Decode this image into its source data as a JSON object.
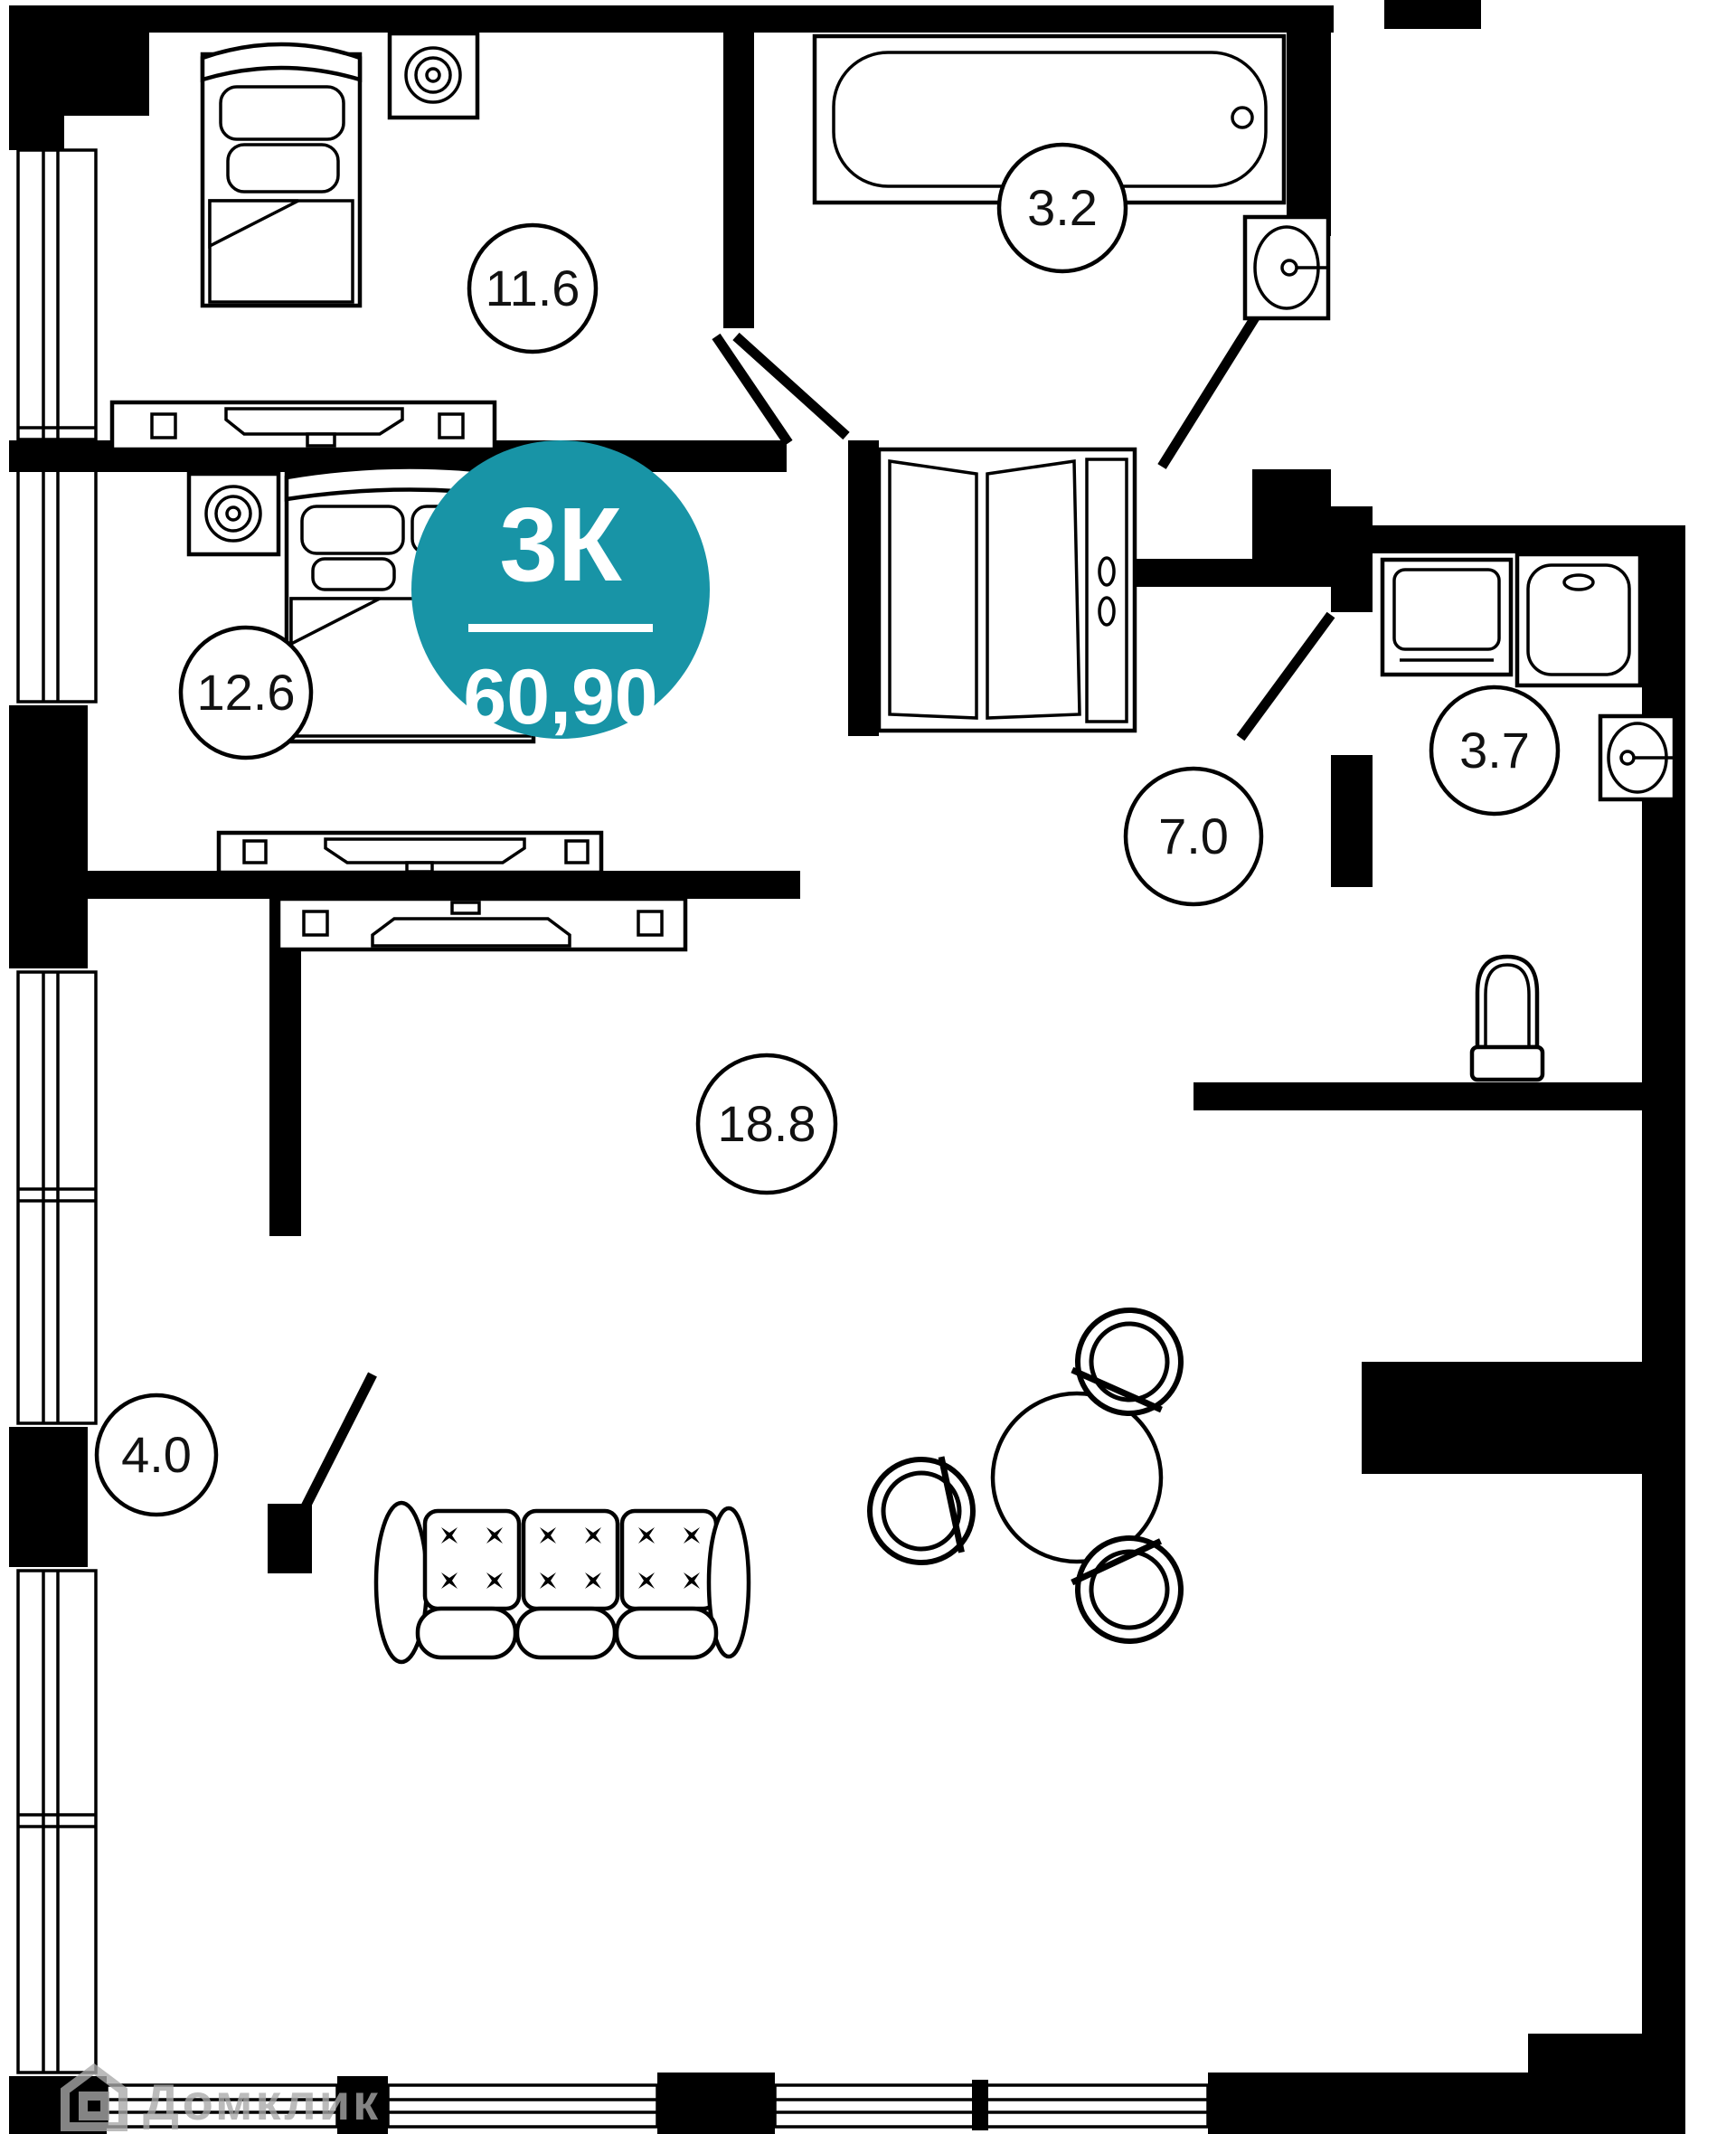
{
  "unit_badge": {
    "type_label": "3К",
    "area_value": "60,90",
    "color": "#1894A6",
    "text_color": "#ffffff"
  },
  "rooms": {
    "bedroom1": {
      "name": "bedroom-top",
      "area": "11.6"
    },
    "bathroom1": {
      "name": "bathroom-top",
      "area": "3.2"
    },
    "bedroom2": {
      "name": "bedroom-middle",
      "area": "12.6"
    },
    "hallway": {
      "name": "hallway",
      "area": "7.0"
    },
    "bathroom2": {
      "name": "bathroom-right",
      "area": "3.7"
    },
    "living_room": {
      "name": "living-room",
      "area": "18.8"
    },
    "storage": {
      "name": "storage-room",
      "area": "4.0"
    }
  },
  "watermark": {
    "text": "Домклик",
    "color": "#a9a9a9"
  },
  "furniture_icons": [
    "single-bed-icon",
    "double-bed-icon",
    "nightstand-speaker-icon",
    "tv-stand-icon",
    "bathtub-icon",
    "sink-icon",
    "washing-machine-icon",
    "shower-cabin-icon",
    "toilet-icon",
    "wardrobe-icon",
    "sofa-icon",
    "dining-table-icon",
    "chair-icon",
    "window-icon",
    "door-leaf-icon"
  ],
  "colors": {
    "walls": "#000000",
    "background": "#ffffff",
    "badge": "#1894A6",
    "label_stroke": "#000000"
  }
}
